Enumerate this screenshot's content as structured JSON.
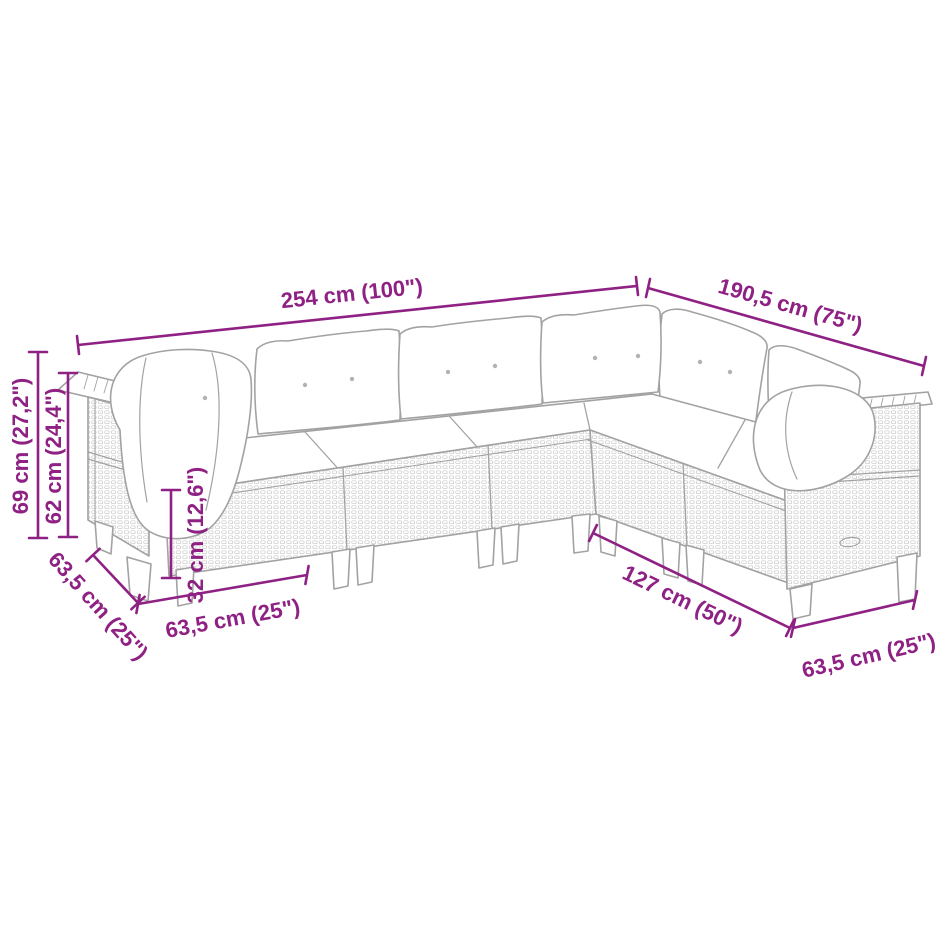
{
  "diagram": {
    "subject": "L-shaped rattan garden sofa set with cushions — dimension diagram",
    "background": "#ffffff"
  },
  "colors": {
    "dimension_accent": "#8e2183",
    "outline_gray": "#a2a2a2",
    "rattan_texture": "#c9c9c9",
    "cushion_fill": "#ffffff"
  },
  "dims": {
    "back_length": "254 cm (100\")",
    "wing_length": "190,5 cm (75\")",
    "total_height": "69 cm (27,2\")",
    "back_height": "62 cm (24,4\")",
    "seat_height": "32 cm (12,6\")",
    "left_seat_depth": "63,5 cm (25\")",
    "seat_width": "63,5 cm (25\")",
    "front_length": "127 cm (50\")",
    "right_seat_width": "63,5 cm (25\")"
  }
}
